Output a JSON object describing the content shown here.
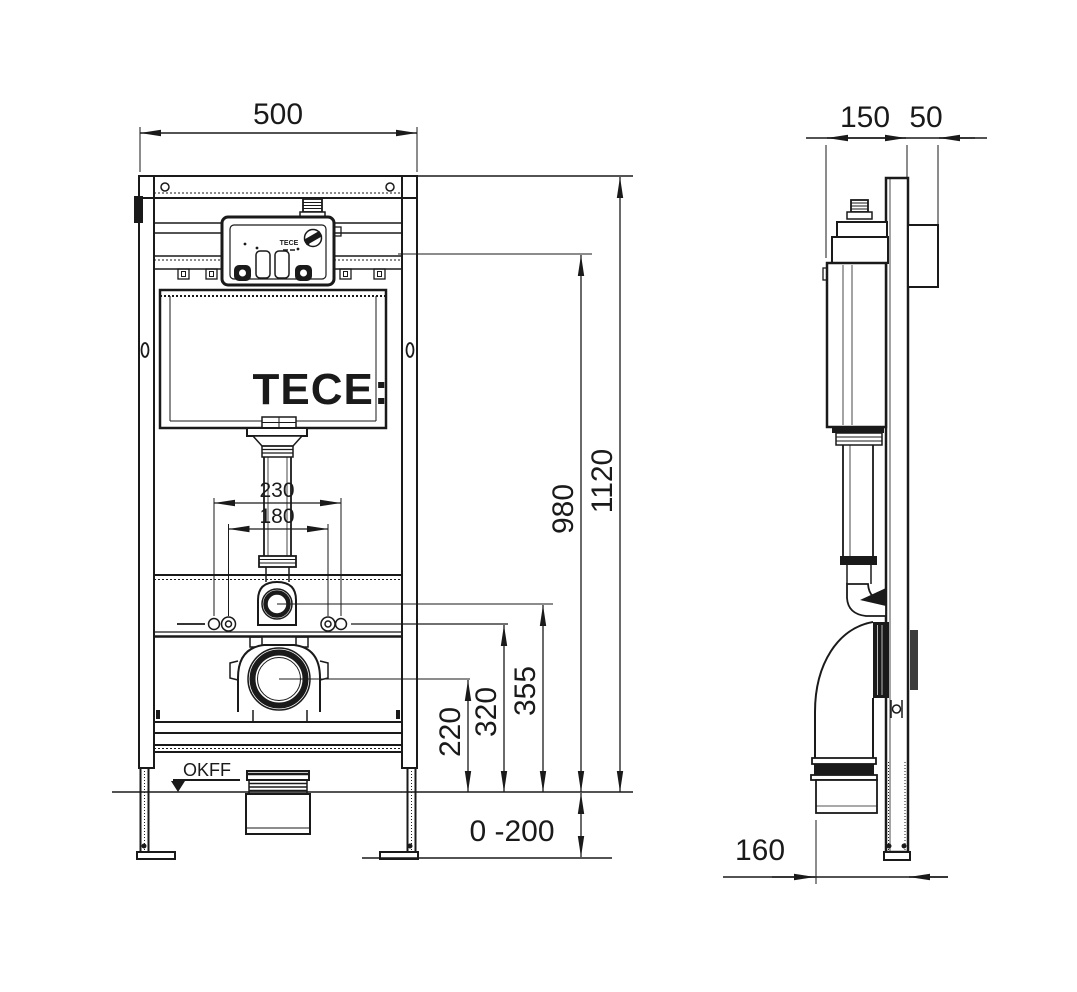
{
  "drawing": {
    "brand_logo": "TECE:",
    "unit_brand": "TECE",
    "front": {
      "width": "500",
      "bolt_span_outer": "230",
      "bolt_span_inner": "180",
      "total_height": "1120",
      "actuation_height": "980",
      "flush_center_height": "355",
      "bolt_height": "320",
      "drain_center_height": "220",
      "foot_adjust_range": "0 -200",
      "floor_label": "OKFF"
    },
    "side": {
      "frame_depth": "150",
      "front_offset": "50",
      "drain_offset": "160"
    }
  }
}
